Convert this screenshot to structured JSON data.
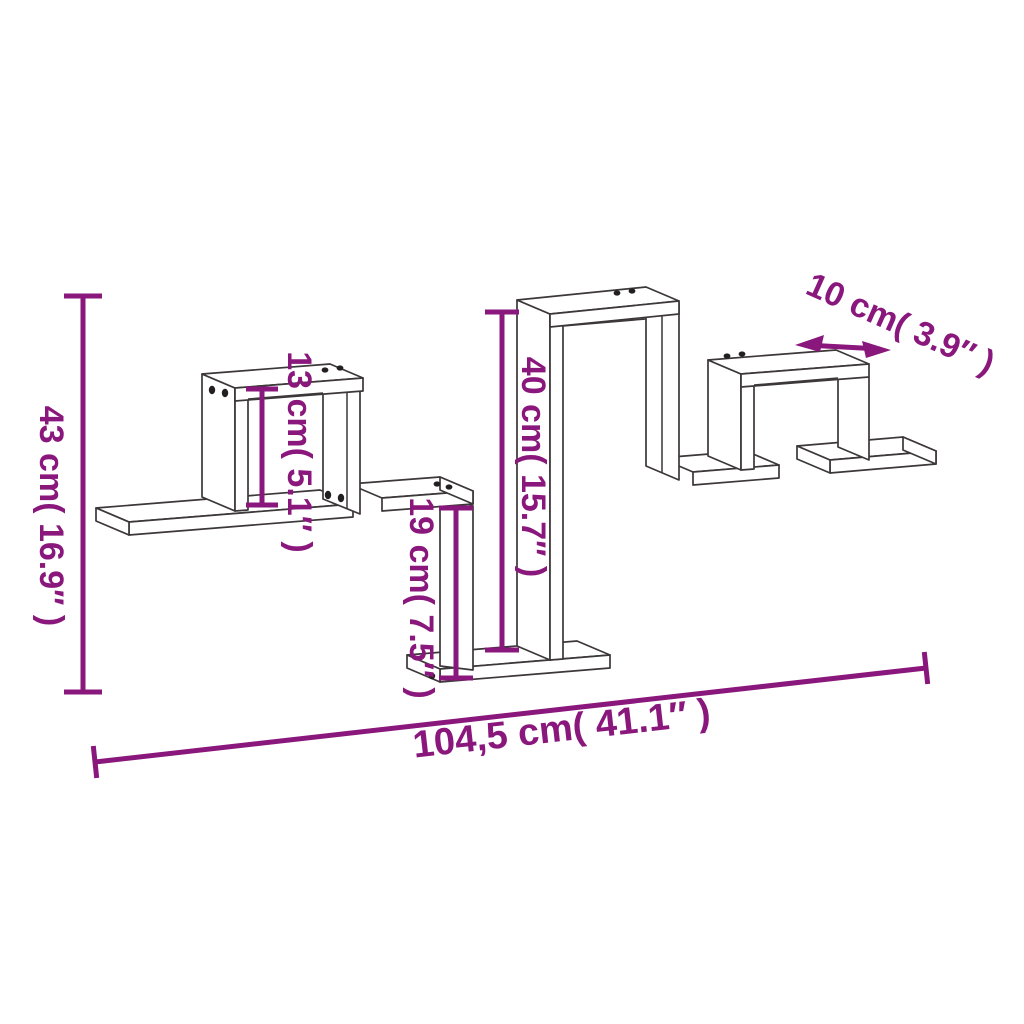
{
  "diagram": {
    "subject": "zigzag wall shelf dimension drawing",
    "background": "#ffffff",
    "line_color": "#3c3738",
    "hole_color": "#231f20",
    "dimension_color": "#8a177c",
    "dimensions": {
      "total_height": {
        "label": "43 cm( 16.9″ )",
        "cm": "43",
        "inch": "16.9"
      },
      "left_cube_height": {
        "label": "13 cm( 5.1″ )",
        "cm": "13",
        "inch": "5.1"
      },
      "column_height": {
        "label": "40 cm( 15.7″ )",
        "cm": "40",
        "inch": "15.7"
      },
      "drop_height": {
        "label": "19 cm( 7.5″ )",
        "cm": "19",
        "inch": "7.5"
      },
      "depth": {
        "label": "10 cm( 3.9″ )",
        "cm": "10",
        "inch": "3.9"
      },
      "total_width": {
        "label": "104,5 cm( 41.1″ )",
        "cm": "104,5",
        "inch": "41.1"
      }
    }
  }
}
